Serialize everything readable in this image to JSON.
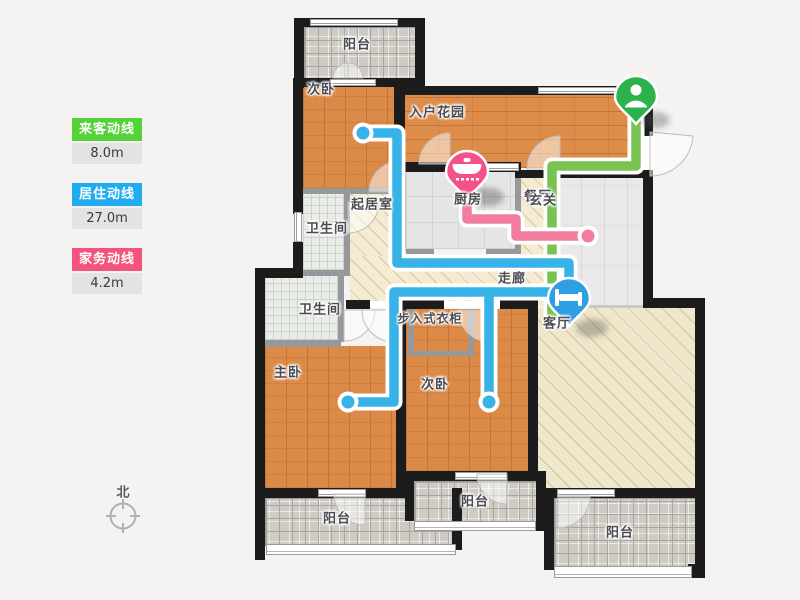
{
  "legend": {
    "items": [
      {
        "label": "来客动线",
        "value": "8.0m",
        "color": "#54d23a"
      },
      {
        "label": "居住动线",
        "value": "27.0m",
        "color": "#21acf2"
      },
      {
        "label": "家务动线",
        "value": "4.2m",
        "color": "#f2547e"
      }
    ]
  },
  "compass": {
    "label": "北"
  },
  "rooms": {
    "balcony_top": "阳台",
    "bedroom_top": "次卧",
    "entry_garden": "入户花园",
    "kitchen": "厨房",
    "foyer": "玄关",
    "dining": "餐厅",
    "family_room": "起居室",
    "bath_upper": "卫生间",
    "bath_lower": "卫生间",
    "corridor": "走廊",
    "closet": "步入式衣柜",
    "master": "主卧",
    "bedroom_second": "次卧",
    "living": "客厅",
    "balcony_bottom_left": "阳台",
    "balcony_bottom_middle": "阳台",
    "balcony_bottom_right": "阳台"
  },
  "pins": {
    "entry": {
      "icon": "person-icon",
      "color": "#2bb24b"
    },
    "kitchen": {
      "icon": "cooking-pot-icon",
      "color": "#f4508a"
    },
    "living": {
      "icon": "bed-icon",
      "color": "#2d9fe2"
    }
  },
  "paths": {
    "guest": {
      "name": "来客动线",
      "color": "#79c353",
      "length": "8.0m"
    },
    "resident": {
      "name": "居住动线",
      "color": "#38b3e8",
      "length": "27.0m"
    },
    "chore": {
      "name": "家务动线",
      "color": "#f27c9e",
      "length": "4.2m"
    }
  }
}
